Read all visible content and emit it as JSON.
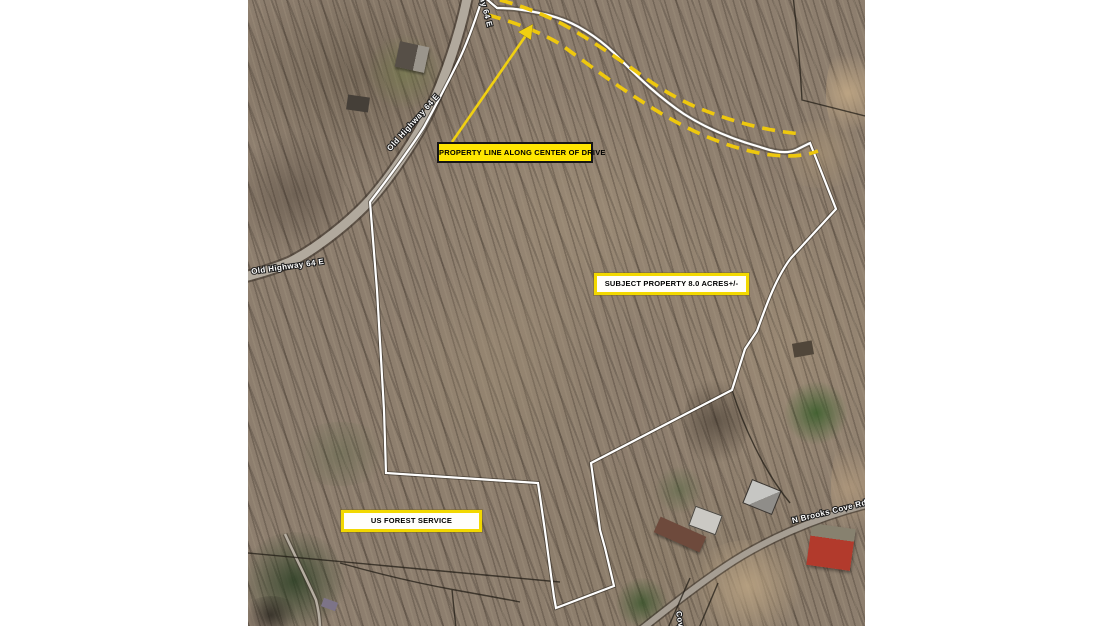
{
  "map": {
    "callouts": {
      "property_line": "PROPERTY LINE ALONG CENTER OF DRIVE",
      "subject_property": "SUBJECT PROPERTY 8.0 ACRES+/-",
      "us_forest": "US FOREST SERVICE"
    },
    "roads": {
      "old_highway_top": "Old Highway 64 E",
      "old_highway_diagonal": "Old Highway 64 E",
      "old_highway_west": "Old Highway 64 E",
      "brooks_cove": "N Brooks Cove Rd",
      "bottom_road_partial": "Cove Rd"
    },
    "colors": {
      "boundary_line": "#ffffff",
      "drive_dashes": "#eec80e",
      "callout_yellow": "#ffe600",
      "callout_border": "#151515"
    }
  }
}
